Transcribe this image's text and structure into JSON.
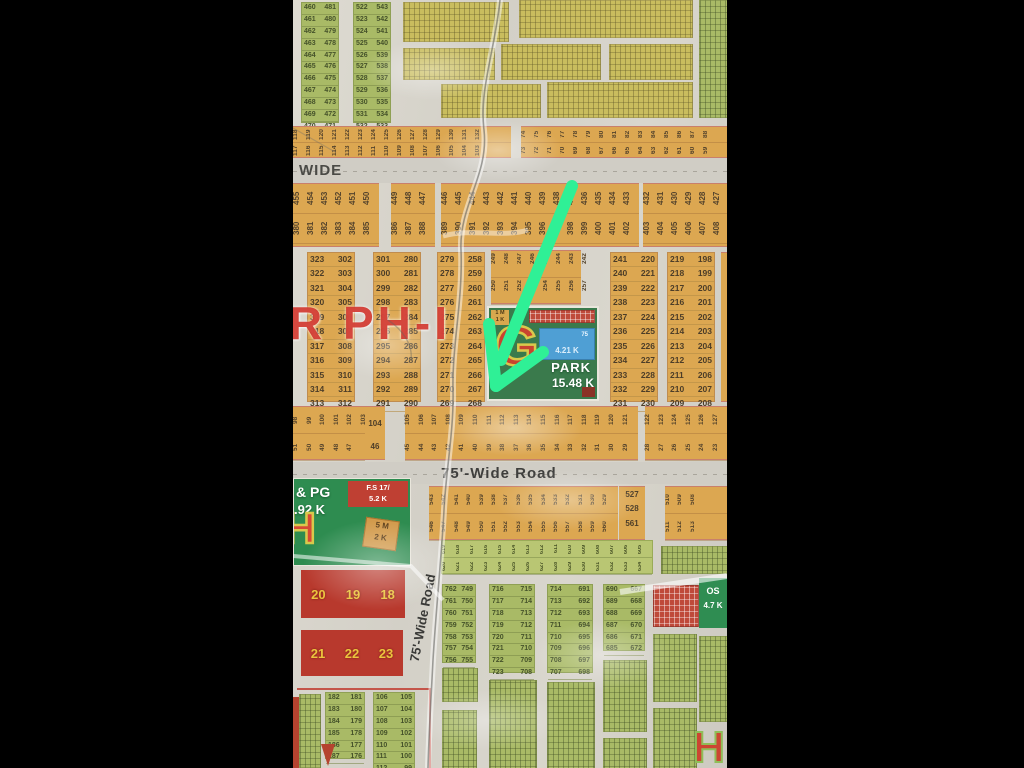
{
  "colors": {
    "arrow_green": "#2ff096",
    "paper": "#d6d3ca",
    "plot_orange": "#dca751",
    "plot_green": "#a9ba66",
    "park_green": "#3a7a4c",
    "block_red": "#b8392d",
    "sector_red": "#ce2c22"
  },
  "sector_label": "R PH-I",
  "roads": {
    "wide_label": "WIDE",
    "wide_road_75": "75'-Wide Road",
    "vertical_road_75": "75'-Wide Road"
  },
  "top": {
    "col_a": [
      "460 481",
      "461 480",
      "462 479",
      "463 478",
      "464 477",
      "465 476",
      "466 475",
      "467 474",
      "468 473",
      "469 472",
      "470 471"
    ],
    "col_b": [
      "522 543",
      "523 542",
      "524 541",
      "525 540",
      "526 539",
      "527 538",
      "528 537",
      "529 536",
      "530 535",
      "531 534",
      "532 533"
    ]
  },
  "band_above_wide": {
    "left_top": [
      "118",
      "119",
      "120",
      "121",
      "122",
      "123",
      "124",
      "125",
      "126",
      "127",
      "128",
      "129",
      "130",
      "131",
      "132"
    ],
    "left_bottom": [
      "117",
      "116",
      "115",
      "114",
      "113",
      "112",
      "111",
      "110",
      "109",
      "108",
      "107",
      "106",
      "105",
      "104",
      "103"
    ],
    "right_top": [
      "74",
      "75",
      "76",
      "77",
      "78",
      "79",
      "80",
      "81",
      "82",
      "83",
      "84",
      "85",
      "86",
      "87",
      "88"
    ],
    "right_bottom": [
      "73",
      "72",
      "71",
      "70",
      "69",
      "68",
      "67",
      "66",
      "65",
      "64",
      "63",
      "62",
      "61",
      "60",
      "59"
    ]
  },
  "band_below_wide": {
    "seg1_top": [
      "455",
      "454",
      "453",
      "452",
      "451",
      "450"
    ],
    "seg1_bottom": [
      "380",
      "381",
      "382",
      "383",
      "384",
      "385"
    ],
    "seg2_top": [
      "449",
      "448",
      "447"
    ],
    "seg2_bottom": [
      "386",
      "387",
      "388"
    ],
    "seg3_top": [
      "446",
      "445",
      "444",
      "443",
      "442",
      "441",
      "440",
      "439",
      "438",
      "437",
      "436",
      "435",
      "434",
      "433"
    ],
    "seg3_bottom": [
      "389",
      "390",
      "391",
      "392",
      "393",
      "394",
      "395",
      "396",
      "397",
      "398",
      "399",
      "400",
      "401",
      "402"
    ],
    "seg4_top": [
      "432",
      "431",
      "430",
      "429",
      "428",
      "427"
    ],
    "seg4_bottom": [
      "403",
      "404",
      "405",
      "406",
      "407",
      "408"
    ]
  },
  "ladder_cols": {
    "col1": [
      "323 302",
      "322 303",
      "321 304",
      "320 305",
      "319 306",
      "318 307",
      "317 308",
      "316 309",
      "315 310",
      "314 311",
      "313 312"
    ],
    "col2": [
      "301 280",
      "300 281",
      "299 282",
      "298 283",
      "297 284",
      "296 285",
      "295 286",
      "294 287",
      "293 288",
      "292 289",
      "291 290"
    ],
    "col3": [
      "279 258",
      "278 259",
      "277 260",
      "276 261",
      "275 262",
      "274 263",
      "273 264",
      "272 265",
      "271 266",
      "270 267",
      "269 268"
    ],
    "col4": [
      "241 220",
      "240 221",
      "239 222",
      "238 223",
      "237 224",
      "236 225",
      "235 226",
      "234 227",
      "233 228",
      "232 229",
      "231 230"
    ],
    "col5": [
      "219 198",
      "218 199",
      "217 200",
      "216 201",
      "215 202",
      "214 203",
      "213 204",
      "212 205",
      "211 206",
      "210 207",
      "209 208"
    ]
  },
  "rot_block": {
    "top": [
      "249",
      "248",
      "247",
      "246",
      "245",
      "244",
      "243",
      "242"
    ],
    "bottom": [
      "250",
      "251",
      "252",
      "253",
      "254",
      "255",
      "256",
      "257"
    ]
  },
  "park": {
    "letter": "G",
    "title": "PARK",
    "area": "15.48 K",
    "pond_num": "75",
    "pond_area": "4.21 K",
    "tag_line1": "1 M",
    "tag_line2": "1 K"
  },
  "band_98": {
    "s1_top": [
      "98",
      "99",
      "100",
      "101",
      "102",
      "103"
    ],
    "s1_top_end": "104",
    "s1_bottom": [
      "51",
      "50",
      "49",
      "48",
      "47"
    ],
    "s1_bottom_end": "46",
    "s2_top": [
      "105",
      "106",
      "107",
      "108",
      "109",
      "110",
      "111",
      "112",
      "113",
      "114",
      "115",
      "116",
      "117",
      "118",
      "119",
      "120",
      "121"
    ],
    "s2_bottom": [
      "45",
      "44",
      "43",
      "42",
      "41",
      "40",
      "39",
      "38",
      "37",
      "36",
      "35",
      "34",
      "33",
      "32",
      "31",
      "30",
      "29"
    ],
    "s3_top": [
      "122",
      "123",
      "124",
      "125",
      "126",
      "127"
    ],
    "s3_bottom": [
      "28",
      "27",
      "26",
      "25",
      "24",
      "23"
    ]
  },
  "band_543": {
    "s1_top": [
      "543",
      "542",
      "541",
      "540",
      "539",
      "538",
      "537",
      "536",
      "535",
      "534",
      "533",
      "532",
      "531",
      "530",
      "529"
    ],
    "s1_bottom": [
      "546",
      "547",
      "548",
      "549",
      "550",
      "551",
      "552",
      "553",
      "554",
      "555",
      "556",
      "557",
      "558",
      "559",
      "560"
    ],
    "end_top": "527",
    "end_mid": "528",
    "end_bottom": "561",
    "s2_top": [
      "510",
      "509",
      "508"
    ],
    "s2_bottom": [
      "511",
      "512",
      "513"
    ]
  },
  "strip_rot_green": {
    "top": [
      "619",
      "618",
      "617",
      "616",
      "615",
      "614",
      "613",
      "612",
      "611",
      "610",
      "609",
      "608",
      "607",
      "606",
      "605"
    ],
    "bottom": [
      "620",
      "621",
      "622",
      "623",
      "624",
      "625",
      "626",
      "627",
      "628",
      "629",
      "630",
      "631",
      "632",
      "633",
      "634"
    ]
  },
  "pg_block": {
    "line1": "& PG",
    "line2": ".92 K",
    "fs_line1": "F.S 17/",
    "fs_line2": "5.2 K",
    "letter": "H",
    "tag_line1": "5 M",
    "tag_line2": "2 K"
  },
  "red_blocks": {
    "row1": [
      "20",
      "19",
      "18"
    ],
    "row2": [
      "21",
      "22",
      "23"
    ]
  },
  "bottom": {
    "ladder_a": [
      "762 749",
      "761 750",
      "760 751",
      "759 752",
      "758 753",
      "757 754",
      "756 755"
    ],
    "ladder_b": [
      "716 715",
      "717 714",
      "718 713",
      "719 712",
      "720 711",
      "721 710",
      "722 709",
      "723 708"
    ],
    "ladder_c": [
      "714 691",
      "713 692",
      "712 693",
      "711 694",
      "710 695",
      "709 696",
      "708 697",
      "707 698"
    ],
    "ladder_d": [
      "690 667",
      "689 668",
      "688 669",
      "687 670",
      "686 671",
      "685 672"
    ],
    "ladder_l2": [
      "182 181",
      "183 180",
      "184 179",
      "185 178",
      "186 177",
      "187 176"
    ],
    "ladder_l3": [
      "106 105",
      "107 104",
      "108 103",
      "109 102",
      "110 101",
      "111 100",
      "112 99"
    ],
    "os_line1": "OS",
    "os_line2": "4.7 K",
    "corner_letter": "H"
  }
}
